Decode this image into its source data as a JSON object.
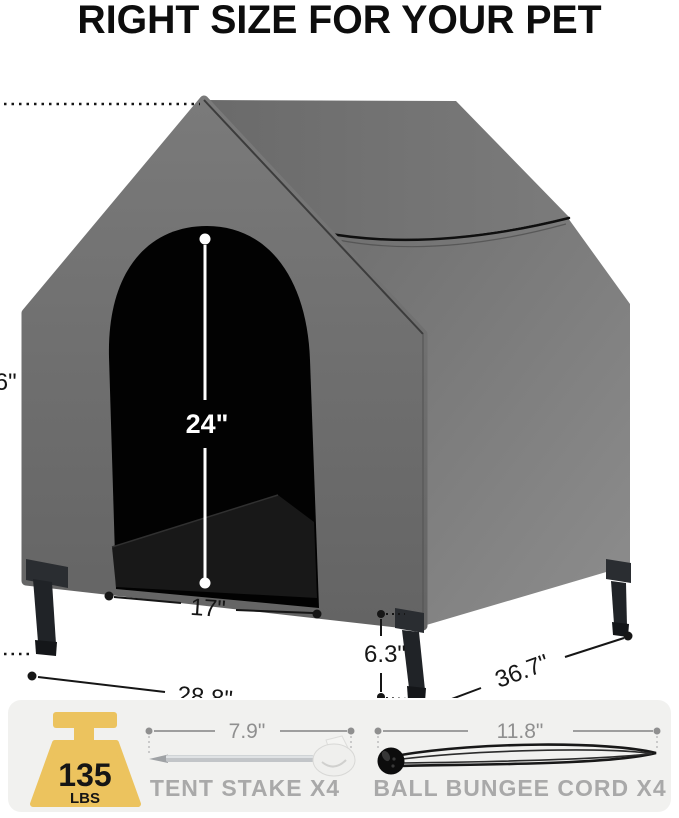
{
  "title": "RIGHT SIZE FOR YOUR PET",
  "dimensions": {
    "overall_height": "40.6\"",
    "door_height": "24\"",
    "door_width": "17\"",
    "leg_height": "6.3\"",
    "front_width": "28.8\"",
    "depth": "36.7\""
  },
  "specs": {
    "weight_capacity_value": "135",
    "weight_capacity_unit": "LBS",
    "tent_stake_length": "7.9\"",
    "tent_stake_label": "TENT STAKE X4",
    "bungee_length": "11.8\"",
    "bungee_label": "BALL BUNGEE CORD X4"
  },
  "colors": {
    "house_front_gray": "#6b6b6b",
    "house_side_gray": "#7f7f7f",
    "door_black": "#020202",
    "accent_gold": "#ecc35e",
    "label_gray": "#a9a9a9",
    "panel_bg": "#f1f1ef",
    "measure_black": "#161616",
    "measure_white": "#ffffff"
  }
}
